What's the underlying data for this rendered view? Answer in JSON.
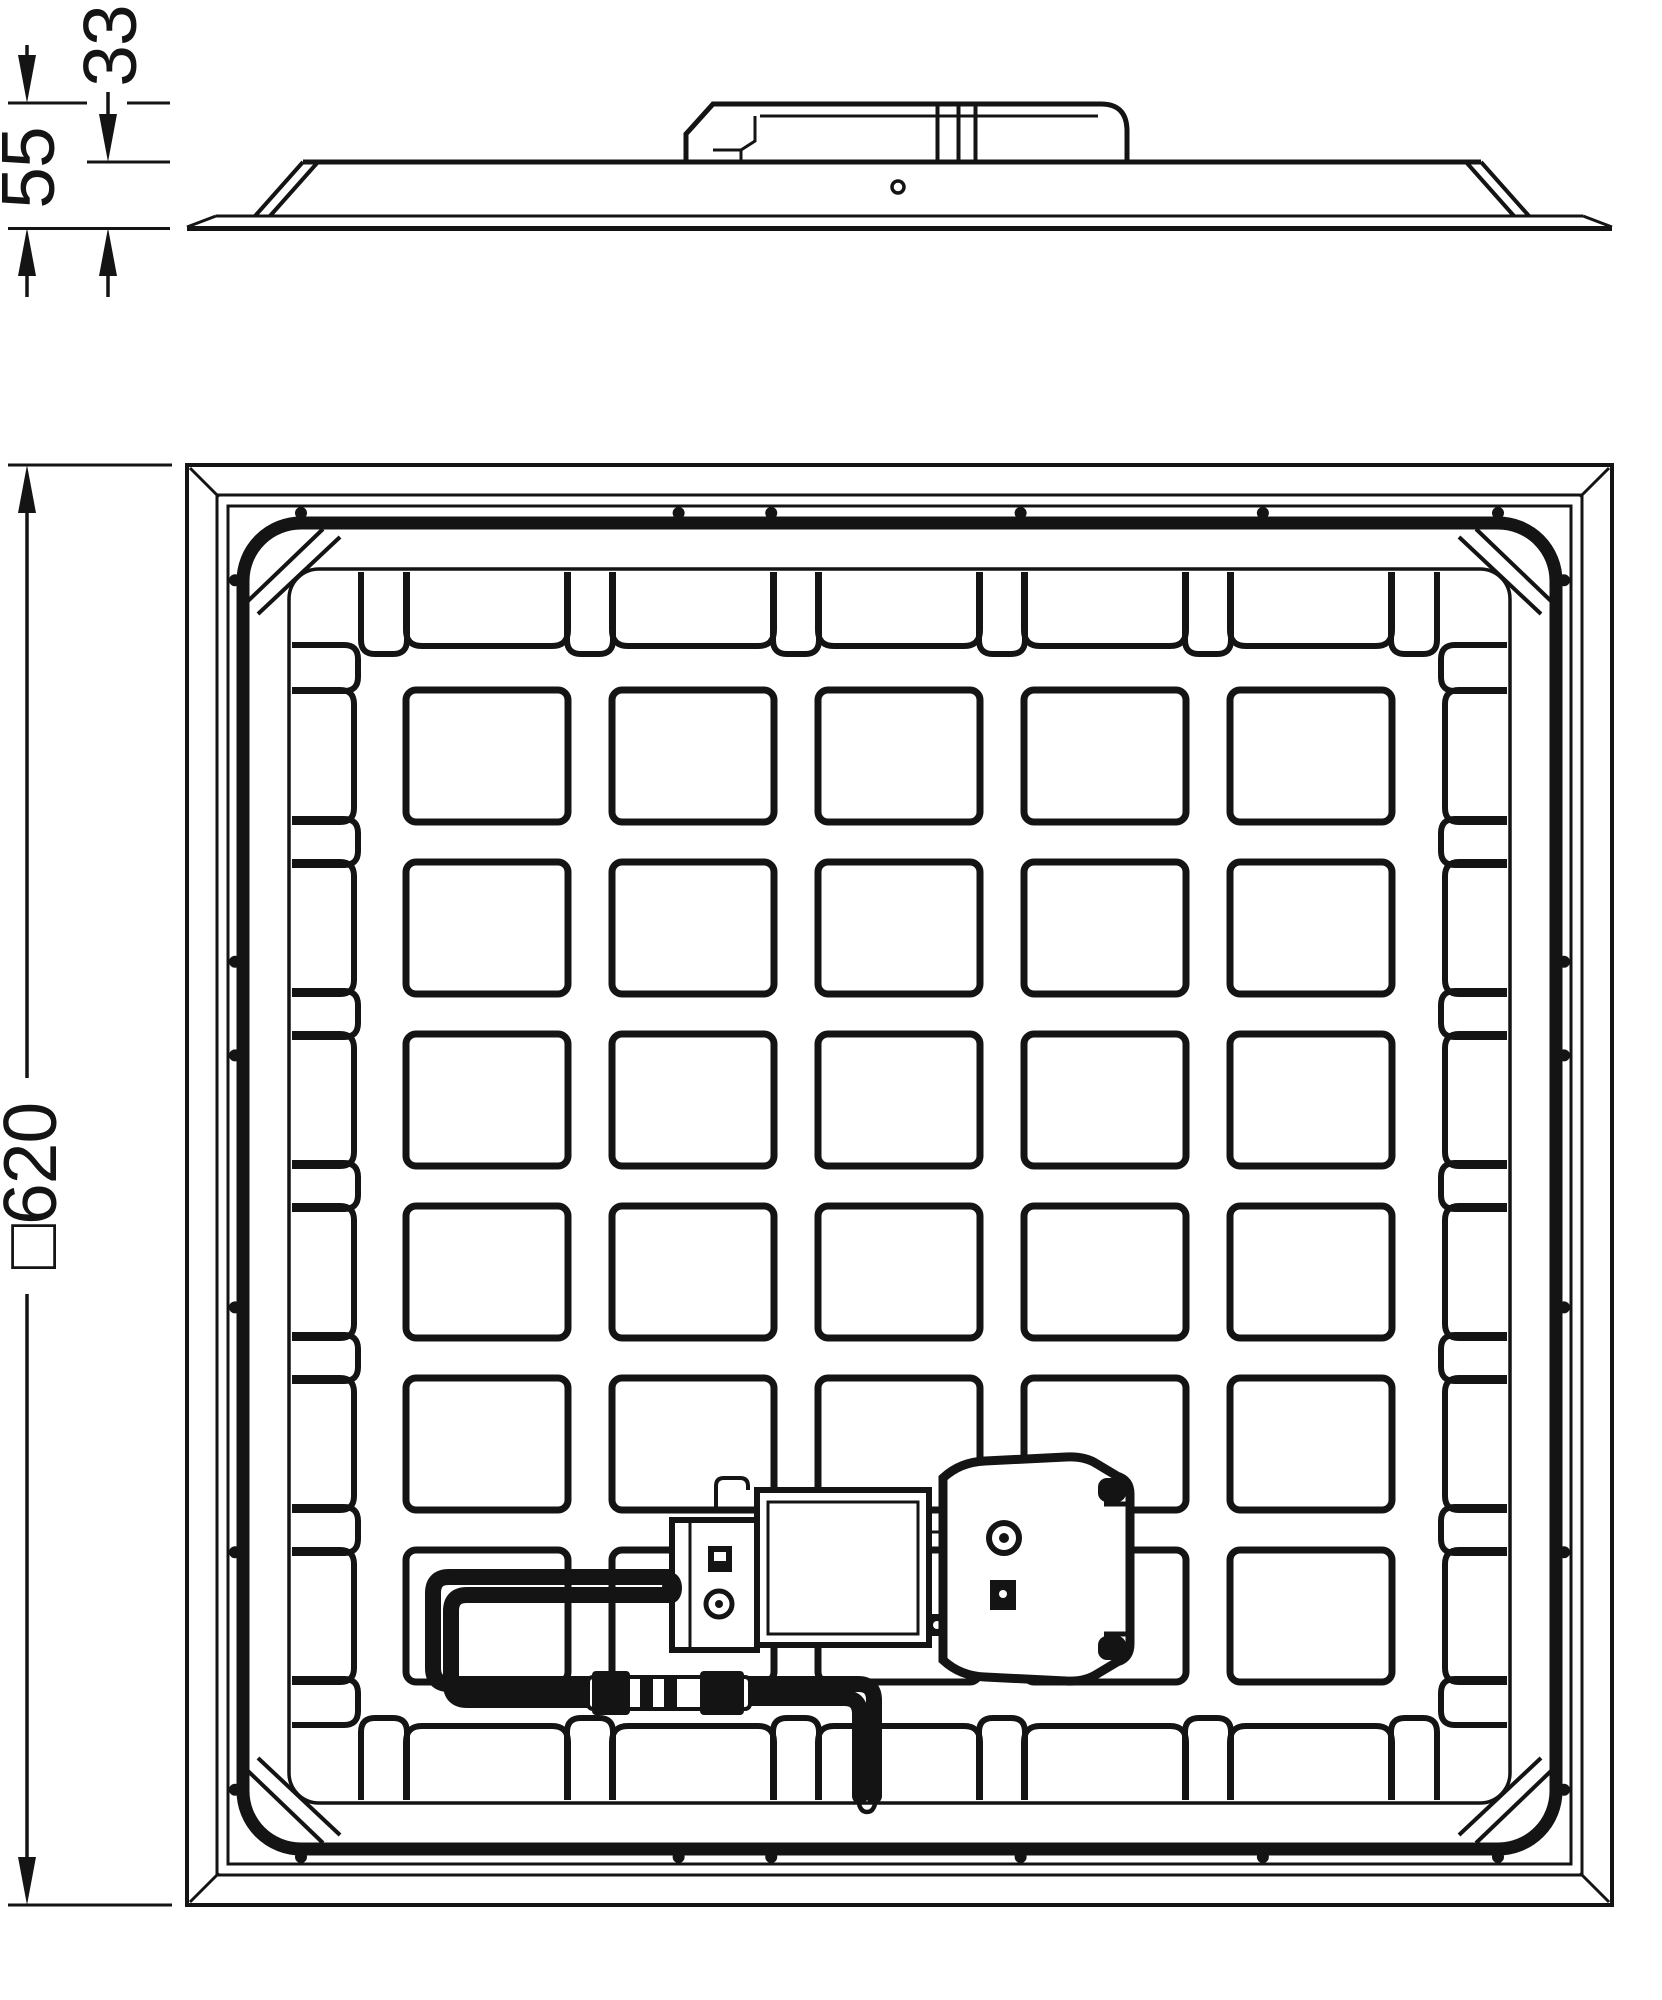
{
  "page": {
    "background_color": "#ffffff",
    "line_color": "#141414"
  },
  "drawing": {
    "type": "luminaire-technical-drawing",
    "side_view": {
      "name": "side-profile-view",
      "total_height_label": "55",
      "panel_height_label": "33"
    },
    "rear_view": {
      "name": "rear-view",
      "size_label": "□620",
      "grid_rows": 6,
      "grid_cols": 5
    }
  }
}
